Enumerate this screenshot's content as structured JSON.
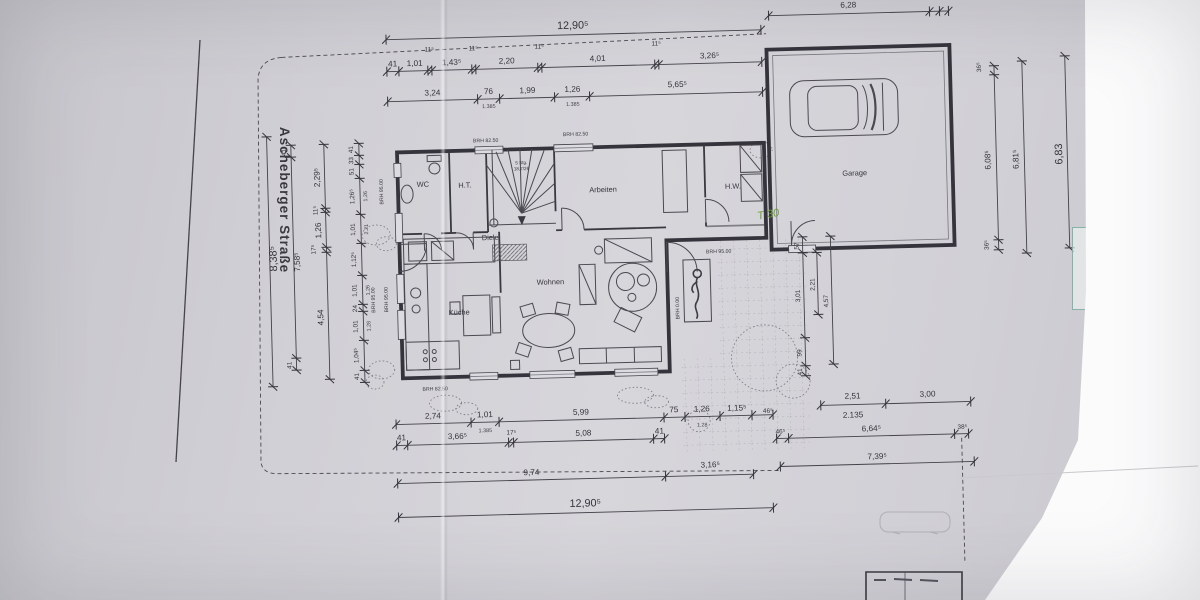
{
  "street": {
    "label": "Ascheberger Straße"
  },
  "rooms": {
    "wc": "WC",
    "ht": "H.T.",
    "stairs1": "5 Stg.",
    "stairs2": "18,7/26",
    "arbeiten": "Arbeiten",
    "hw": "H.W.",
    "diele": "Diele",
    "kueche": "Küche",
    "wohnen": "Wohnen",
    "garage": "Garage"
  },
  "brh": {
    "b8250": "BRH 82.50",
    "b9500": "BRH 95.00",
    "b000": "BRH 0.00"
  },
  "notes": {
    "t30": "T 30"
  },
  "dim": {
    "d12905": "12,90⁵",
    "d115": "11⁵",
    "d41": "41",
    "d101": "1,01",
    "d1435": "1,43⁵",
    "d220": "2,20",
    "d401": "4,01",
    "d3265": "3,26⁵",
    "d324": "3,24",
    "d76": "76",
    "d199": "1,99",
    "d126": "1,26",
    "d5655": "5,65⁵",
    "s1385": "1.385",
    "s221": "2.21",
    "s126": "1.26",
    "s128": "1.28",
    "g628": "6,28",
    "g365": "36⁵",
    "g385": "38⁵",
    "r6085": "6,08⁵",
    "r6815": "6,81⁵",
    "r683": "6,83",
    "l8385": "8,38⁵",
    "l7585": "7,58⁵",
    "l2295": "2,29⁵",
    "l454": "4,54",
    "l175": "17⁵",
    "l33": "33",
    "l51": "51",
    "l1265": "1,26⁵",
    "l1125": "1,12⁵",
    "l24": "24",
    "l1045": "1,04⁵",
    "b274": "2,74",
    "b599": "5,99",
    "b75": "75",
    "b1155": "1,15⁵",
    "b465": "46⁵",
    "b3665": "3,66⁵",
    "b508": "5,08",
    "b974": "9,74",
    "b3165": "3,16⁵",
    "n57": "57",
    "n301": "3,01",
    "n221": "2,21",
    "n457": "4,57",
    "n99": "99",
    "q251": "2,51",
    "q300": "3,00",
    "q2135": "2.135",
    "q6645": "6,64⁵",
    "q7395": "7,39⁵"
  }
}
